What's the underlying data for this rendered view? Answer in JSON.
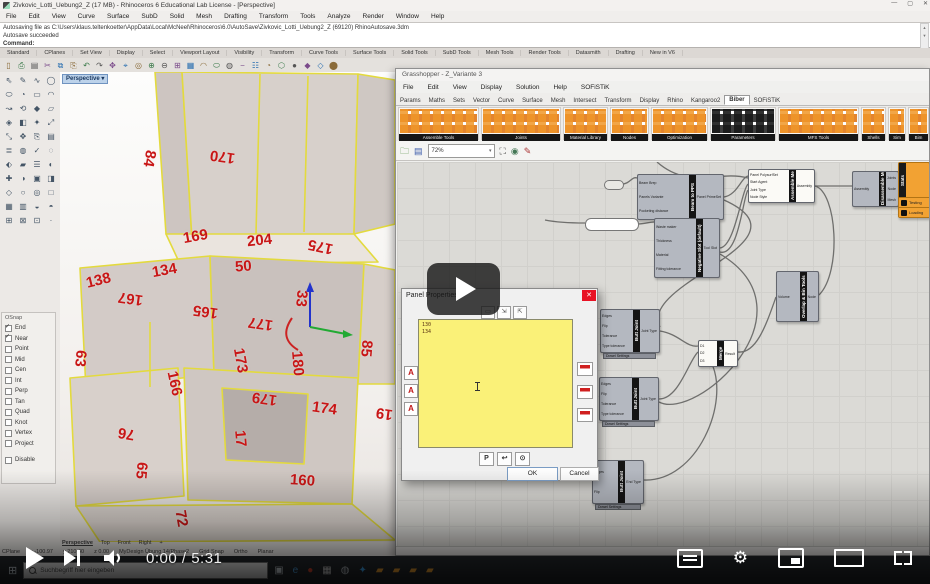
{
  "video": {
    "time": "0:00 / 5:31"
  },
  "taskbar": {
    "search_placeholder": "Suchbegriff hier eingeben",
    "icons": [
      {
        "glyph": "▣",
        "color": "#cdd5db"
      },
      {
        "glyph": "e",
        "color": "#4fa3e3"
      },
      {
        "glyph": "●",
        "color": "#d4452f"
      },
      {
        "glyph": "▦",
        "color": "#d8d8d8"
      },
      {
        "glyph": "◍",
        "color": "#bfc6cc"
      },
      {
        "glyph": "✦",
        "color": "#3fa9f5"
      },
      {
        "glyph": "▰",
        "color": "#f0a030"
      },
      {
        "glyph": "▰",
        "color": "#f0a030"
      },
      {
        "glyph": "▰",
        "color": "#f0a030"
      },
      {
        "glyph": "▰",
        "color": "#f0a030"
      }
    ]
  },
  "rhino": {
    "title": "Zivkovic_Lotti_Uebung2_Z (17 MB) - Rhinoceros 6 Educational Lab License - [Perspective]",
    "window_buttons": {
      "min": "—",
      "max": "▢",
      "close": "✕"
    },
    "menu": [
      "File",
      "Edit",
      "View",
      "Curve",
      "Surface",
      "SubD",
      "Solid",
      "Mesh",
      "Drafting",
      "Transform",
      "Tools",
      "Analyze",
      "Render",
      "Window",
      "Help"
    ],
    "command_lines": [
      "Autosaving file as C:\\Users\\klaus.teltenkoetter\\AppData\\Local\\McNeel\\Rhinoceros\\6.0\\AutoSave\\Zivkovic_Lotti_Uebung2_Z (69120) RhinoAutosave.3dm",
      "Autosave succeeded"
    ],
    "command_prompt": "Command:",
    "toolbar_tabs": [
      "Standard",
      "CPlanes",
      "Set View",
      "Display",
      "Select",
      "Viewport Layout",
      "Visibility",
      "Transform",
      "Curve Tools",
      "Surface Tools",
      "Solid Tools",
      "SubD Tools",
      "Mesh Tools",
      "Render Tools",
      "Datasmith",
      "Drafting",
      "New in V6"
    ],
    "top_icons": [
      "▯",
      "⎙",
      "▤",
      "✂",
      "⧉",
      "⎘",
      "↶",
      "↷",
      "✥",
      "⌖",
      "◎",
      "⊕",
      "⊖",
      "⊞",
      "▦",
      "◠",
      "⬭",
      "◍",
      "−",
      "☷",
      "◔",
      "⬡",
      "●",
      "◆",
      "◇",
      "⬤"
    ],
    "side_icons": [
      "⇖",
      "✎",
      "∿",
      "◯",
      "⬭",
      "◔",
      "▭",
      "◠",
      "↝",
      "⟲",
      "◆",
      "▱",
      "◈",
      "◧",
      "✦",
      "⤢",
      "⤡",
      "✥",
      "⎘",
      "▤",
      "≣",
      "◍",
      "✓",
      "◌",
      "⬖",
      "▰",
      "☰",
      "◐",
      "✚",
      "◑",
      "▣",
      "◨",
      "◇",
      "○",
      "◎",
      "□",
      "▦",
      "▥",
      "◒",
      "◓",
      "⊞",
      "⊠",
      "⊡",
      "·"
    ],
    "viewport_label": "Perspective",
    "viewport_tabs": [
      {
        "label": "Perspective",
        "active": true
      },
      {
        "label": "Top"
      },
      {
        "label": "Front"
      },
      {
        "label": "Right"
      },
      {
        "label": "+"
      }
    ],
    "osnap": {
      "title": "OSnap",
      "items": [
        {
          "label": "End",
          "checked": true
        },
        {
          "label": "Near",
          "checked": true
        },
        {
          "label": "Point"
        },
        {
          "label": "Mid"
        },
        {
          "label": "Cen"
        },
        {
          "label": "Int"
        },
        {
          "label": "Perp"
        },
        {
          "label": "Tan"
        },
        {
          "label": "Quad"
        },
        {
          "label": "Knot"
        },
        {
          "label": "Vertex"
        },
        {
          "label": "Project"
        }
      ],
      "disable_label": "Disable"
    },
    "status": [
      "CPlane",
      "x -100.97",
      "y 210.40",
      "z 0.00",
      "MyDesign Übung 14/Phase2",
      "Grid Snap",
      "Ortho",
      "Planar"
    ],
    "dims": [
      {
        "v": "84",
        "x": 81,
        "y": 78,
        "r": 100
      },
      {
        "v": "170",
        "x": 150,
        "y": 76,
        "r": 188
      },
      {
        "v": "169",
        "x": 123,
        "y": 156,
        "r": -10
      },
      {
        "v": "204",
        "x": 187,
        "y": 160,
        "r": -6
      },
      {
        "v": "175",
        "x": 248,
        "y": 166,
        "r": 192
      },
      {
        "v": "134",
        "x": 92,
        "y": 190,
        "r": -10
      },
      {
        "v": "50",
        "x": 175,
        "y": 186,
        "r": -4
      },
      {
        "v": "138",
        "x": 26,
        "y": 200,
        "r": -14
      },
      {
        "v": "167",
        "x": 58,
        "y": 218,
        "r": 188
      },
      {
        "v": "33",
        "x": 233,
        "y": 218,
        "r": 95
      },
      {
        "v": "165",
        "x": 133,
        "y": 231,
        "r": 188
      },
      {
        "v": "177",
        "x": 188,
        "y": 243,
        "r": 188
      },
      {
        "v": "63",
        "x": 12,
        "y": 278,
        "r": 95
      },
      {
        "v": "173",
        "x": 168,
        "y": 280,
        "r": 80
      },
      {
        "v": "180",
        "x": 225,
        "y": 283,
        "r": 85
      },
      {
        "v": "166",
        "x": 102,
        "y": 303,
        "r": 78
      },
      {
        "v": "179",
        "x": 192,
        "y": 318,
        "r": 188
      },
      {
        "v": "85",
        "x": 298,
        "y": 268,
        "r": 95
      },
      {
        "v": "174",
        "x": 252,
        "y": 328,
        "r": 8
      },
      {
        "v": "19",
        "x": 316,
        "y": 333,
        "r": 188
      },
      {
        "v": "76",
        "x": 58,
        "y": 353,
        "r": 190
      },
      {
        "v": "17",
        "x": 172,
        "y": 358,
        "r": 85
      },
      {
        "v": "65",
        "x": 73,
        "y": 390,
        "r": 95
      },
      {
        "v": "160",
        "x": 230,
        "y": 400,
        "r": 4
      },
      {
        "v": "72",
        "x": 113,
        "y": 438,
        "r": 80
      }
    ]
  },
  "grasshopper": {
    "title": "Grasshopper - Z_Variante 3",
    "menu": [
      "File",
      "Edit",
      "View",
      "Display",
      "Solution",
      "Help",
      "SOFiSTiK"
    ],
    "tabs": [
      {
        "label": "Params"
      },
      {
        "label": "Maths"
      },
      {
        "label": "Sets"
      },
      {
        "label": "Vector"
      },
      {
        "label": "Curve"
      },
      {
        "label": "Surface"
      },
      {
        "label": "Mesh"
      },
      {
        "label": "Intersect"
      },
      {
        "label": "Transform"
      },
      {
        "label": "Display"
      },
      {
        "label": "Rhino"
      },
      {
        "label": "Kangaroo2"
      },
      {
        "label": "Biber",
        "active": true
      },
      {
        "label": "SOFiSTiK"
      }
    ],
    "groups": [
      {
        "label": "Assemble Tools",
        "x": 2,
        "w": 81
      },
      {
        "label": "Joints",
        "x": 85,
        "w": 80
      },
      {
        "label": "Material Library",
        "x": 167,
        "w": 45
      },
      {
        "label": "Nodes",
        "x": 214,
        "w": 39
      },
      {
        "label": "Optimization",
        "x": 255,
        "w": 57
      },
      {
        "label": "Parameters",
        "x": 314,
        "w": 66,
        "dark": true
      },
      {
        "label": "MFS Tools",
        "x": 382,
        "w": 81
      },
      {
        "label": "Shells",
        "x": 465,
        "w": 25
      },
      {
        "label": "Sim",
        "x": 492,
        "w": 18
      },
      {
        "label": "Bim",
        "x": 512,
        "w": 21
      }
    ],
    "zoom_level": "72%",
    "components": {
      "beam_to_pps": {
        "label": "Beam to PPS",
        "inputs": [
          "Beam Brep",
          "Panels Variante",
          "Pocketing distance"
        ],
        "outputs": [
          "Panel PrimeSet"
        ]
      },
      "negative_slot": {
        "label": "Negative Slot (default)",
        "inputs": [
          "Waste maker",
          "Thickness",
          "Material",
          "Fitting tolerance"
        ],
        "outputs": [
          "Tool Slot"
        ]
      },
      "assemble_me": {
        "label": "Assemble Me",
        "inputs": [
          "Panel PolysurfSet",
          "Start Agent",
          "Joint Type",
          "Node Style"
        ],
        "outputs": [
          "Assembly"
        ]
      },
      "disassemble_me": {
        "label": "Disassemble Me",
        "inputs": [
          "Assembly"
        ],
        "outputs": [
          "Joints",
          "Node",
          "Mesh"
        ]
      },
      "stats": {
        "label": "Stats",
        "rows": [
          "Testing",
          "Loading"
        ]
      },
      "overlap": {
        "label": "Overlap & Bin Tools",
        "inputs": [
          "Volume"
        ],
        "outputs": [
          "Node"
        ]
      },
      "butt_joint_a": {
        "label": "Butt Joint",
        "inputs": [
          "Edges",
          "Flip",
          "Tolerance",
          "Type tolerance"
        ],
        "outputs": [
          "Joint Type"
        ],
        "footer": "Dowel Settings"
      },
      "butt_joint_b": {
        "label": "Butt Joint",
        "inputs": [
          "Edges",
          "Flip",
          "Tolerance",
          "Type tolerance"
        ],
        "outputs": [
          "Joint Type"
        ],
        "footer": "Dowel Settings"
      },
      "butt_joint_c": {
        "label": "Butt Joint",
        "inputs": [
          "Edges",
          "Flip"
        ],
        "outputs": [
          "End Type"
        ],
        "footer": "Dowel Settings"
      },
      "merge": {
        "label": "Merge",
        "inputs": [
          "D1",
          "D2",
          "D3"
        ],
        "outputs": [
          "Result"
        ]
      }
    }
  },
  "panel_dialog": {
    "title": "Panel Properties",
    "close_glyph": "✕",
    "toolbar_glyphs": [
      "▭",
      "⇲",
      "⇱"
    ],
    "content_lines": [
      "130",
      "134"
    ],
    "left_buttons": [
      "A",
      "A",
      "A"
    ],
    "bottom_buttons": [
      "P",
      "↩",
      "⊙"
    ],
    "ok_label": "OK",
    "cancel_label": "Cancel"
  }
}
